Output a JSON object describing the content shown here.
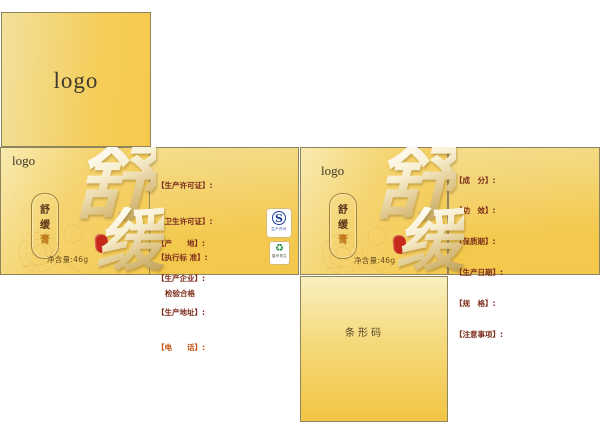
{
  "colors": {
    "gold_light": "#f8eab0",
    "gold_deep": "#f4c94f",
    "panel_border": "#8f855c",
    "logo_text": "#3d3a2c",
    "label_maroon": "#7d2d1c",
    "label_orange": "#c65310",
    "pill_border": "#a5803a",
    "pill_text": "#5a3418",
    "pill_accent": "#c07818",
    "seal_red": "#c5291b",
    "qs_blue": "#1c3f9c",
    "recycle_green": "#1e8a3e",
    "calligraphy_gold": "#bda05a"
  },
  "lid": {
    "logo": "logo"
  },
  "front_face": {
    "logo": "logo",
    "pill_chars": [
      "舒",
      "缓",
      "膏"
    ],
    "calligraphy": [
      "舒",
      "缓"
    ],
    "net_weight": "净含量:46g"
  },
  "info_center": {
    "group1": [
      "【生产许可证】:",
      "【卫生许可证】:",
      "【执行标 准】:",
      "检验合格"
    ],
    "group2": [
      "【产　　地】:",
      "【生产企业】:",
      "【生产地址】:",
      "【电　　话】:"
    ],
    "qs_badge": {
      "letter": "S",
      "caption": "生产许可"
    },
    "recycle_badge": {
      "icon": "♻",
      "caption": "循环再生"
    }
  },
  "info_right": {
    "lines": [
      "【成　分】:",
      "【功　效】:",
      "【保质期】:",
      "【生产日期】:",
      "【规　格】:",
      "【注意事项】:"
    ]
  },
  "bottom_panel": {
    "label": "条形码"
  }
}
